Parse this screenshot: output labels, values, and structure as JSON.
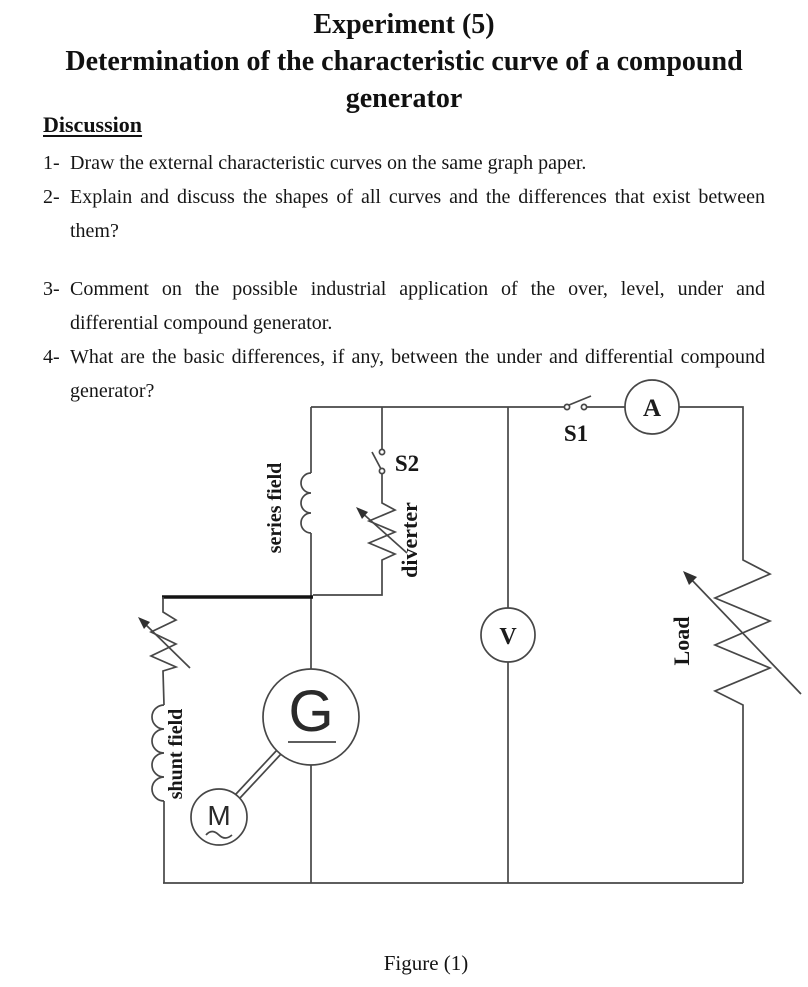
{
  "title": {
    "line1": "Experiment (5)",
    "line2": "Determination of the characteristic curve of a compound generator"
  },
  "discussion": {
    "heading": "Discussion",
    "items": [
      {
        "num": "1-",
        "text": "Draw the external characteristic curves on the same graph paper."
      },
      {
        "num": "2-",
        "text": "Explain and discuss the shapes of all curves and the differences that exist between them?"
      },
      {
        "num": "3-",
        "text": "Comment on the possible industrial application of the over, level, under and differential compound generator."
      },
      {
        "num": "4-",
        "text": "What are the basic differences, if any, between the under and differential compound generator?"
      }
    ]
  },
  "figure": {
    "caption": "Figure (1)",
    "labels": {
      "series_field": "series field",
      "diverter": "diverter",
      "shunt_field": "shunt field",
      "load": "Load",
      "switch_s1": "S1",
      "switch_s2": "S2",
      "ammeter": "A",
      "voltmeter": "V",
      "generator": "G",
      "motor": "M"
    }
  }
}
